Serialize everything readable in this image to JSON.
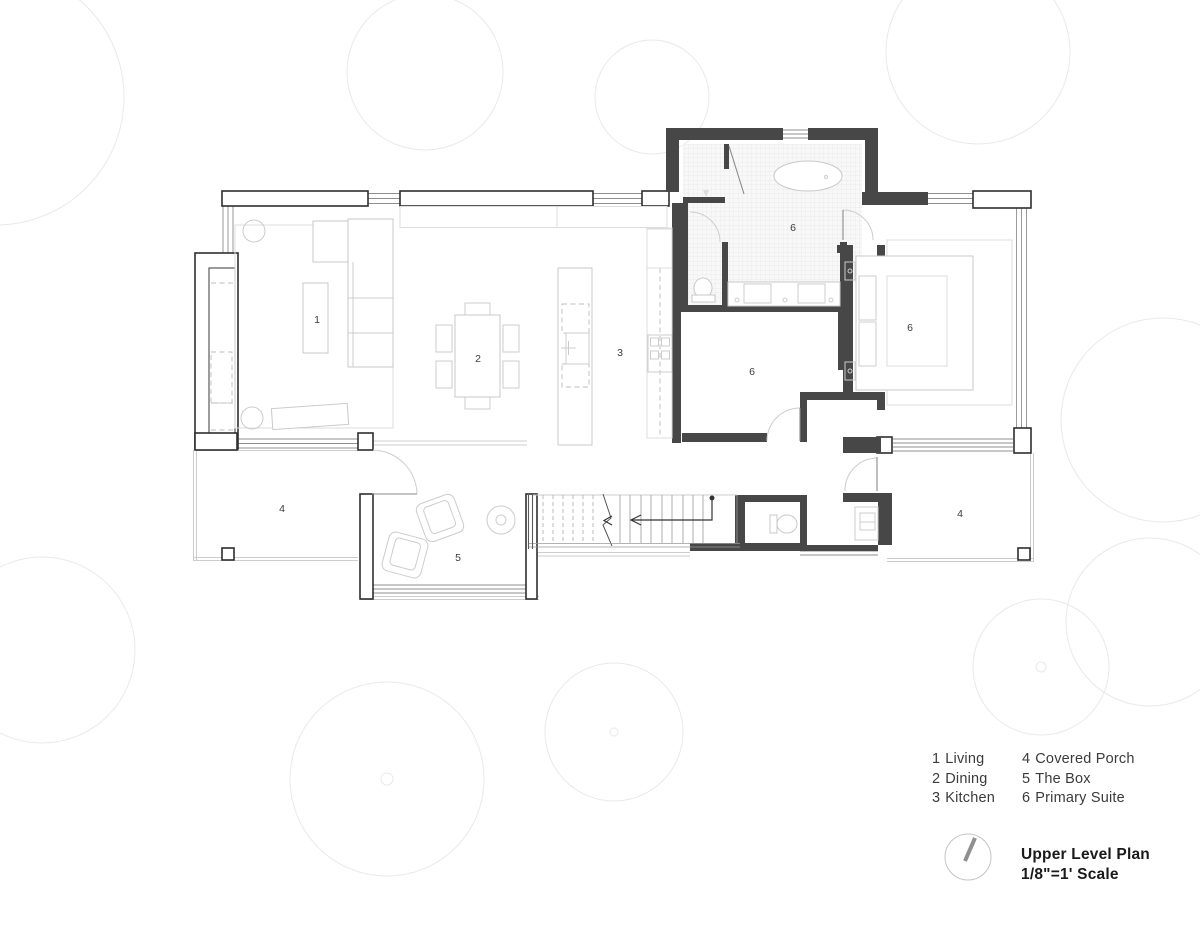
{
  "sheet": {
    "type": "architectural-floor-plan",
    "background": "#ffffff"
  },
  "plan": {
    "room_labels": [
      {
        "room": "living",
        "num": "1"
      },
      {
        "room": "dining",
        "num": "2"
      },
      {
        "room": "kitchen",
        "num": "3"
      },
      {
        "room": "bathroom",
        "num": "6"
      },
      {
        "room": "closet",
        "num": "6"
      },
      {
        "room": "bedroom",
        "num": "6"
      },
      {
        "room": "the-box",
        "num": "5"
      },
      {
        "room": "porch-left",
        "num": "4"
      },
      {
        "room": "porch-right",
        "num": "4"
      }
    ]
  },
  "legend": {
    "columns": [
      {
        "items": [
          {
            "num": "1",
            "label": "Living"
          },
          {
            "num": "2",
            "label": "Dining"
          },
          {
            "num": "3",
            "label": "Kitchen"
          }
        ]
      },
      {
        "items": [
          {
            "num": "4",
            "label": "Covered Porch"
          },
          {
            "num": "5",
            "label": "The Box"
          },
          {
            "num": "6",
            "label": "Primary Suite"
          }
        ]
      }
    ]
  },
  "title_block": {
    "title": "Upper Level Plan",
    "scale_note": "1/8\"=1' Scale"
  },
  "icons": {
    "north_arrow": "north-arrow-icon"
  },
  "colors": {
    "wall": "#474747",
    "furniture_line": "#cccccc",
    "tree_line": "#e9e9e9",
    "text": "#3b3b3b"
  }
}
